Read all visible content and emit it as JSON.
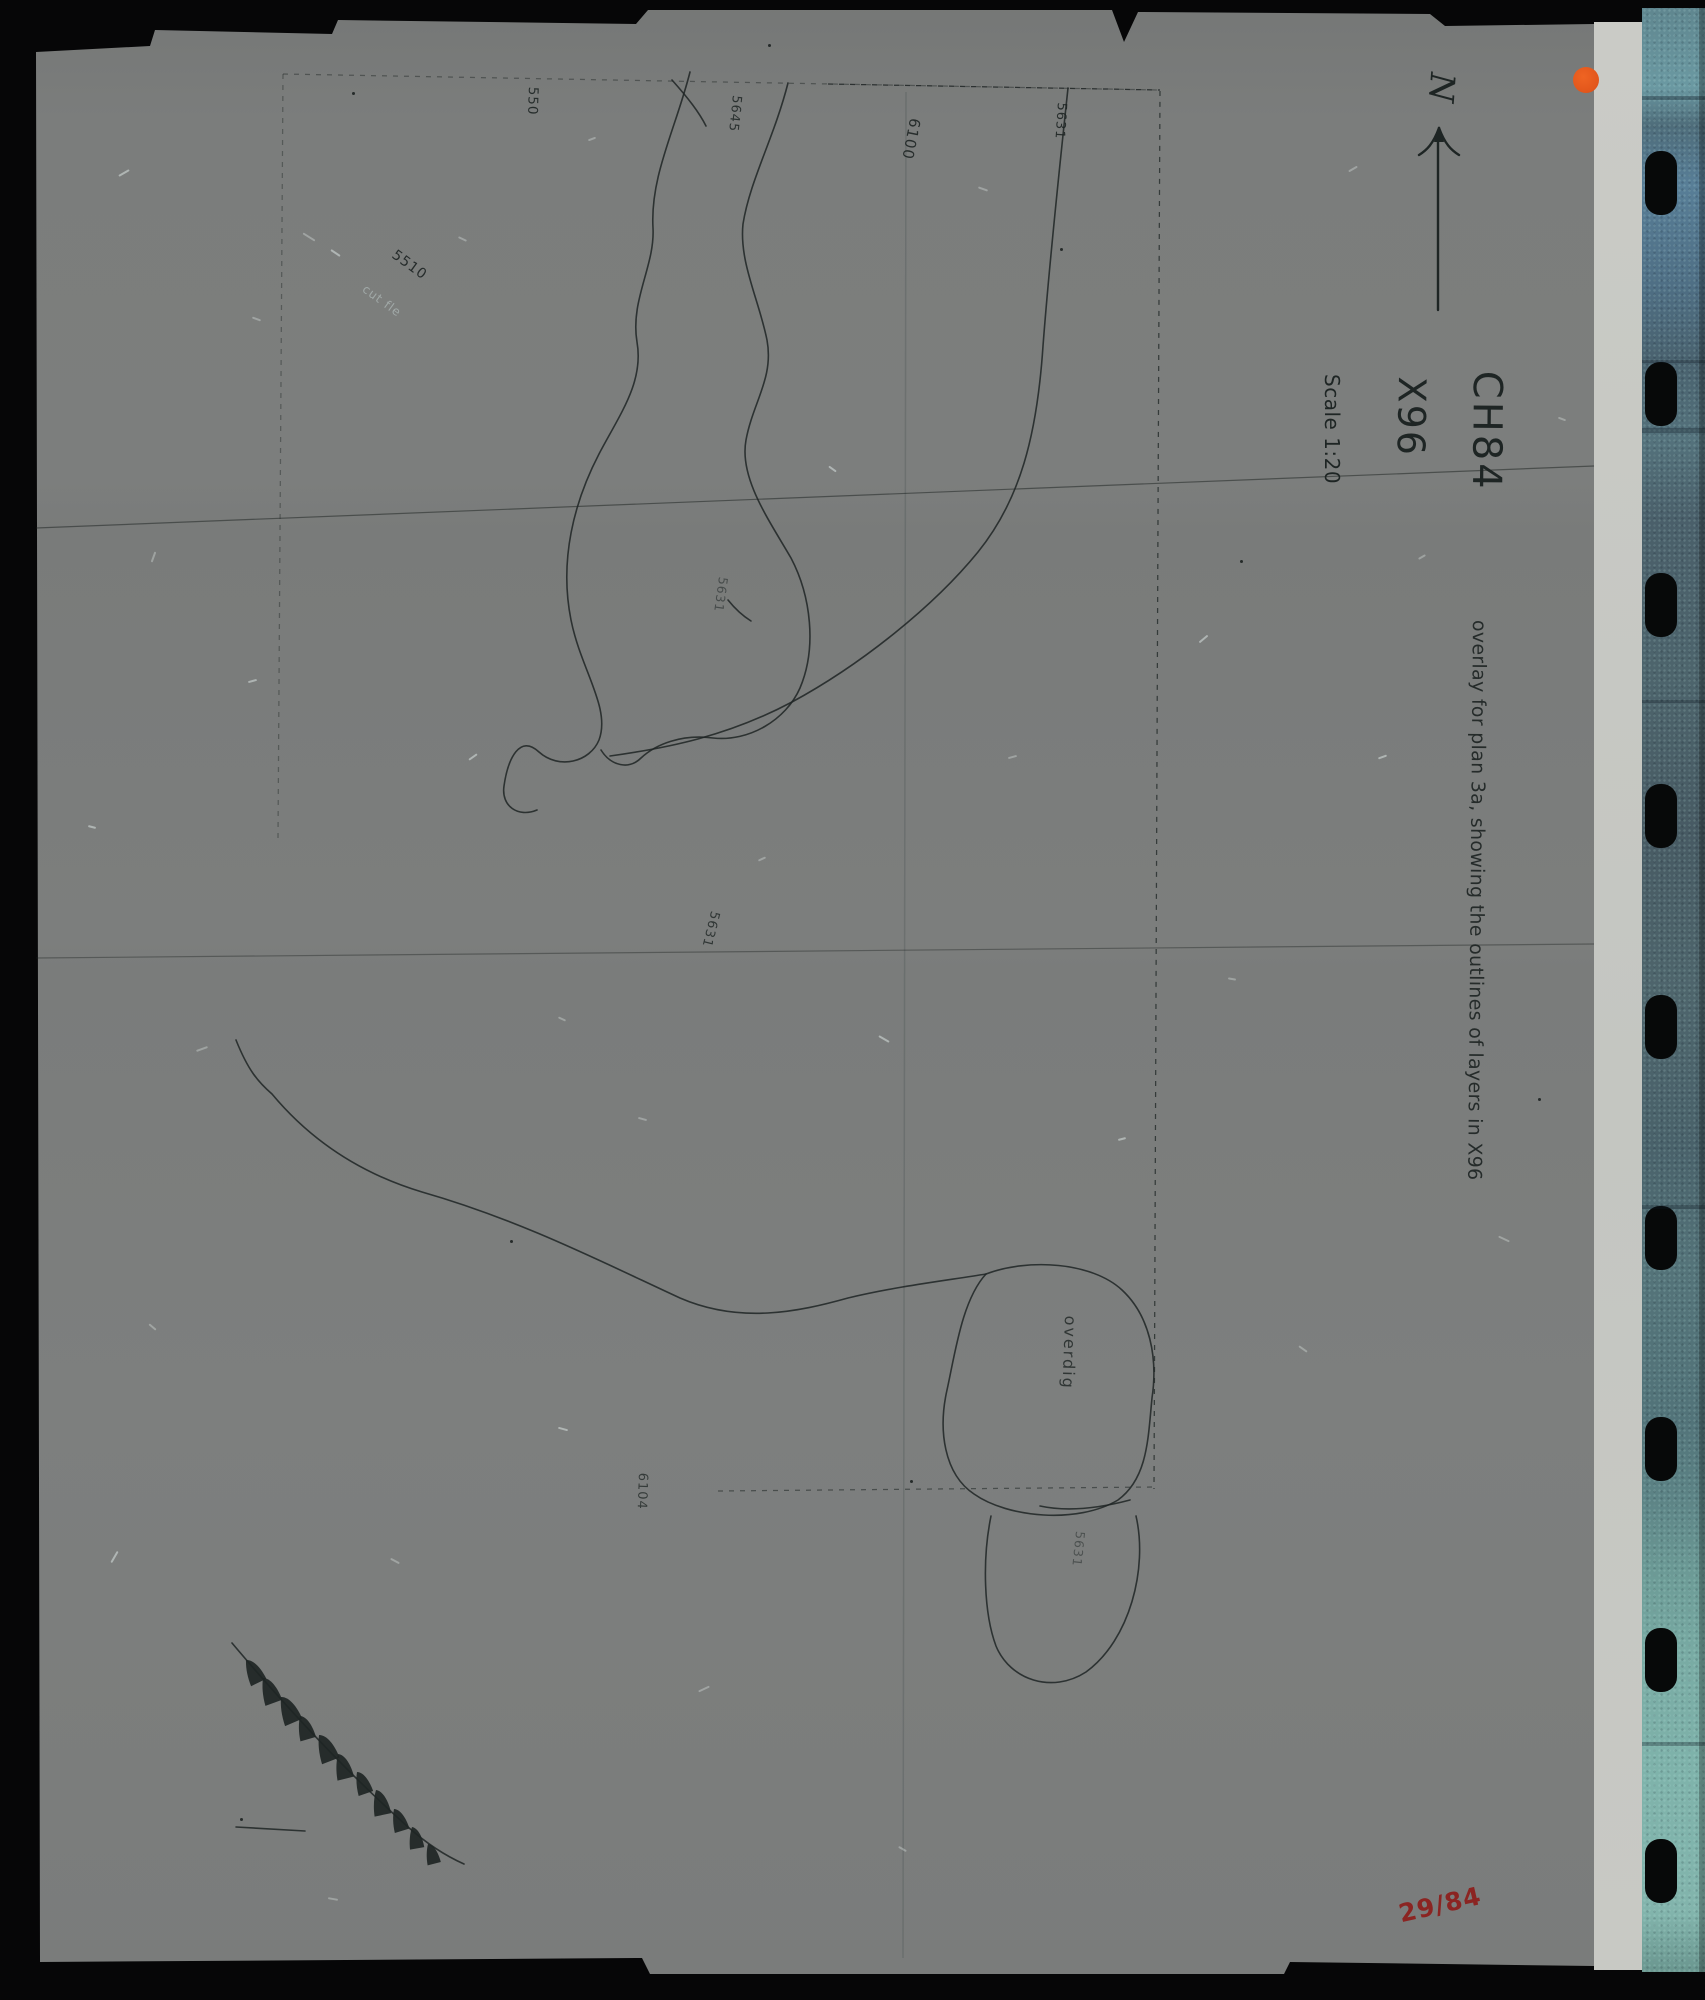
{
  "header": {
    "site_code": "CH84",
    "area_code": "X96",
    "scale": "Scale 1:20",
    "north": "N"
  },
  "annotation": {
    "text": "overlay for plan 3a, showing the outlines of layers in X96"
  },
  "film": {
    "frame_number": "29/84",
    "holes": {
      "count": 9,
      "start_y": 183,
      "spacing": 211
    },
    "bands": [
      [
        96,
        4
      ],
      [
        360,
        3
      ],
      [
        428,
        5
      ],
      [
        700,
        3
      ],
      [
        1205,
        4
      ],
      [
        1742,
        4
      ]
    ]
  },
  "context_labels": [
    {
      "text": "550",
      "x": 541,
      "y": 87,
      "rot": 92,
      "size": 13.5,
      "opacity": 0.9
    },
    {
      "text": "5645",
      "x": 744,
      "y": 96,
      "rot": 96,
      "size": 13,
      "opacity": 0.85
    },
    {
      "text": "6100",
      "x": 924,
      "y": 120,
      "rot": 101,
      "size": 15,
      "opacity": 0.9
    },
    {
      "text": "5631",
      "x": 1069,
      "y": 103,
      "rot": 94,
      "size": 13,
      "opacity": 0.9
    },
    {
      "text": "5510",
      "x": 398,
      "y": 247,
      "rot": 36,
      "size": 14,
      "opacity": 0.92
    },
    {
      "text": "cut fle",
      "x": 368,
      "y": 282,
      "rot": 36,
      "size": 12,
      "opacity": 0.5,
      "light": true
    },
    {
      "text": "5631",
      "x": 731,
      "y": 578,
      "rot": 98,
      "size": 12.5,
      "opacity": 0.55
    },
    {
      "text": "5631",
      "x": 722,
      "y": 913,
      "rot": 104,
      "size": 13,
      "opacity": 0.8
    },
    {
      "text": "overdig",
      "x": 1080,
      "y": 1316,
      "rot": 92,
      "size": 16,
      "opacity": 0.8,
      "spacing": 2
    },
    {
      "text": "5631",
      "x": 1088,
      "y": 1532,
      "rot": 96,
      "size": 12.5,
      "opacity": 0.5
    },
    {
      "text": "6104",
      "x": 650,
      "y": 1473,
      "rot": 92,
      "size": 13,
      "opacity": 0.75
    }
  ],
  "colors": {
    "ink": "#1e2524",
    "red": "#8b2422",
    "orange": "#e2561b",
    "sheet": "#7b7d7c",
    "edge_strip": "#c7c8c3",
    "film_teal_bottom": "#7fb3ab",
    "background": "#060607"
  },
  "hachures": [
    [
      246,
      1660,
      2,
      1.0
    ],
    [
      263,
      1678,
      8,
      1.05
    ],
    [
      281,
      1697,
      5,
      1.1
    ],
    [
      300,
      1716,
      12,
      0.95
    ],
    [
      319,
      1735,
      7,
      1.1
    ],
    [
      338,
      1754,
      14,
      1.0
    ],
    [
      357,
      1772,
      9,
      0.9
    ],
    [
      376,
      1790,
      16,
      1.0
    ],
    [
      394,
      1809,
      11,
      0.9
    ],
    [
      412,
      1827,
      18,
      0.85
    ],
    [
      428,
      1844,
      14,
      0.8
    ]
  ],
  "artifacts": {
    "flecks": [
      [
        118,
        172,
        -30,
        12
      ],
      [
        252,
        318,
        20,
        9
      ],
      [
        148,
        556,
        -70,
        11
      ],
      [
        88,
        826,
        15,
        8
      ],
      [
        196,
        1048,
        -20,
        12
      ],
      [
        148,
        1326,
        40,
        9
      ],
      [
        108,
        1556,
        -60,
        13
      ],
      [
        328,
        1898,
        10,
        10
      ],
      [
        558,
        1018,
        25,
        8
      ],
      [
        468,
        756,
        -35,
        10
      ],
      [
        638,
        1118,
        15,
        9
      ],
      [
        758,
        858,
        -25,
        8
      ],
      [
        878,
        1038,
        30,
        12
      ],
      [
        1008,
        756,
        -15,
        9
      ],
      [
        978,
        188,
        20,
        10
      ],
      [
        1198,
        638,
        -40,
        11
      ],
      [
        1228,
        978,
        10,
        8
      ],
      [
        1298,
        1348,
        35,
        10
      ],
      [
        1378,
        756,
        -20,
        9
      ],
      [
        1498,
        1238,
        25,
        12
      ],
      [
        1418,
        556,
        -30,
        8
      ],
      [
        558,
        1428,
        15,
        10
      ],
      [
        698,
        1688,
        -25,
        12
      ],
      [
        898,
        1848,
        30,
        9
      ],
      [
        1118,
        1138,
        -15,
        8
      ],
      [
        458,
        238,
        25,
        9
      ],
      [
        588,
        138,
        -20,
        8
      ],
      [
        828,
        468,
        35,
        9
      ],
      [
        1348,
        168,
        -30,
        10
      ],
      [
        1558,
        418,
        20,
        8
      ],
      [
        248,
        680,
        -15,
        9
      ],
      [
        390,
        1560,
        28,
        10
      ],
      [
        302,
        236,
        32,
        14
      ],
      [
        330,
        252,
        34,
        11
      ]
    ],
    "specks": [
      [
        352,
        92
      ],
      [
        768,
        44
      ],
      [
        1240,
        560
      ],
      [
        240,
        1818
      ],
      [
        1538,
        1098
      ],
      [
        910,
        1480
      ],
      [
        1060,
        248
      ],
      [
        510,
        1240
      ]
    ]
  }
}
